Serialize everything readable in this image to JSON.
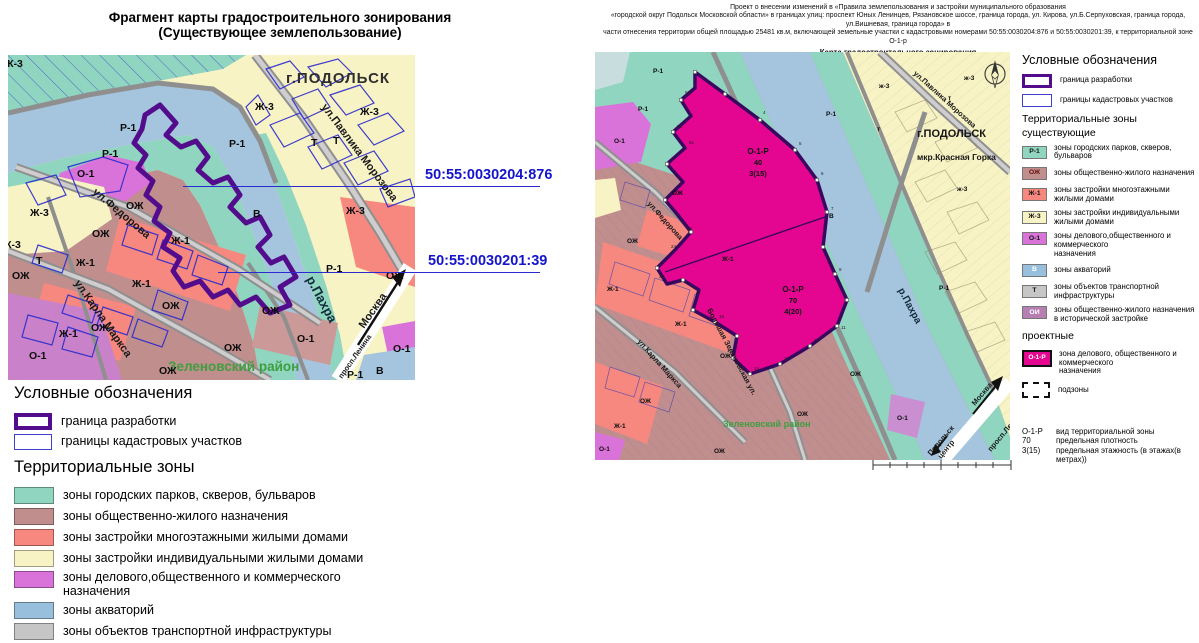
{
  "colors": {
    "boundary_purple": "#530d8c",
    "cadastral_blue": "#2a2ace",
    "magenta_project_zone": "#e40591",
    "teal_parks": "#8fd5bf",
    "rose_ozh": "#c18e8e",
    "salmon_zh1": "#f6887f",
    "yellow_zh3": "#f8f3c4",
    "orchid_o1": "#d973d9",
    "water": "#a5c4de",
    "gray_transport": "#c6c6c6",
    "mauve_oi": "#b77fb1",
    "green_district_text": "#3f9e3f",
    "blue_label_text": "#1414cc"
  },
  "left": {
    "title1": "Фрагмент карты градостроительного зонирования",
    "title2": "(Существующее землепользование)",
    "cad1": "50:55:0030204:876",
    "cad2": "50:55:0030201:39",
    "city": "г.ПОДОЛЬСК",
    "district": "Зеленовский район",
    "river": "р.Пахра",
    "moscow": "Москва",
    "st_lenina": "просп.Ленина",
    "st_pavlika": "ул.Павлика Морозова",
    "st_fedorova": "ул.Федорова",
    "st_karla": "ул.Карла Маркса",
    "codes": {
      "r1": "Р-1",
      "o1": "О-1",
      "zh1": "Ж-1",
      "zh3": "Ж-3",
      "ozh": "ОЖ",
      "t": "Т",
      "v": "В"
    },
    "legend": {
      "title": "Условные обозначения",
      "boundary": "граница разработки",
      "cadastral": "границы кадастровых участков",
      "zones_title": "Территориальные зоны",
      "items": [
        {
          "label": "зоны городских парков, скверов, бульваров",
          "label2": ""
        },
        {
          "label": "зоны общественно-жилого назначения",
          "label2": ""
        },
        {
          "label": "зоны застройки многоэтажными жилыми домами",
          "label2": ""
        },
        {
          "label": "зоны застройки индивидуальными жилыми домами",
          "label2": ""
        },
        {
          "label": "зоны делового,общественного и коммерческого",
          "label2": "назначения"
        },
        {
          "label": "зоны акваторий",
          "label2": ""
        },
        {
          "label": "зоны объектов транспортной инфраструктуры",
          "label2": ""
        },
        {
          "label": "зоны общественно-жилого назначения",
          "label2": "в исторической застройке"
        }
      ]
    }
  },
  "right": {
    "header1": "Проект о внесении изменений в «Правила землепользования и застройки муниципального образования",
    "header2": "«городской округ Подольск Московской области» в границах улиц: проспект Юных Ленинцев, Рязановское шоссе, граница города, ул. Кирова, ул.Б.Серпуховская, граница города, ул.Вишневая, граница города» в",
    "header3": "части отнесения территории общей площадью 25481 кв.м, включающей земельные участки с кадастровыми номерами 50:55:0030204:876 и 50:55:0030201:39, к территориальной зоне О-1-р",
    "header4": "Карта градостроительного зонирования",
    "city": "г.ПОДОЛЬСК",
    "mkr": "мкр.Красная Горка",
    "district": "Зеленовский район",
    "river": "р.Пахра",
    "moscow": "Москва",
    "center1": "Подольск",
    "center2": "центр",
    "st_lenina": "просп.Ленина",
    "st_pavlika": "ул.Павлика Морозова",
    "st_fedorova": "ул.Федорова",
    "st_karla": "ул.Карла Маркса",
    "st_zelenov": "Большая Зеленовская ул.",
    "codes": {
      "r1": "Р-1",
      "o1": "О-1",
      "zh1": "Ж-1",
      "zh3": "ж-3",
      "ozh": "ОЖ",
      "t": "т",
      "v": "В"
    },
    "zone1": {
      "code": "О-1-Р",
      "density": "40",
      "floors": "3(15)"
    },
    "zone2": {
      "code": "О-1-Р",
      "density": "70",
      "floors": "4(20)"
    },
    "vertices": [
      "53",
      "54",
      "61",
      "4",
      "5",
      "6",
      "7",
      "9",
      "11",
      "12",
      "13",
      "14",
      "15",
      "16",
      "23",
      "24",
      "25"
    ],
    "legend": {
      "title": "Условные обозначения",
      "boundary": "граница разработки",
      "cadastral": "границы кадастровых участков",
      "zones_title": "Территориальные зоны",
      "existing": "существующие",
      "items": [
        {
          "code": "Р-1",
          "text": "зоны городских парков, скверов, бульваров",
          "text2": ""
        },
        {
          "code": "ОЖ",
          "text": "зоны общественно-жилого назначения",
          "text2": ""
        },
        {
          "code": "Ж-1",
          "text": "зоны застройки многоэтажными жилыми домами",
          "text2": ""
        },
        {
          "code": "Ж-3",
          "text": "зоны застройки индивидуальными жилыми домами",
          "text2": ""
        },
        {
          "code": "О-1",
          "text": "зоны делового,общественного и коммерческого",
          "text2": "назначения"
        },
        {
          "code": "В",
          "text": "зоны акваторий",
          "text2": ""
        },
        {
          "code": "Т",
          "text": "зоны объектов транспортной инфраструктуры",
          "text2": ""
        },
        {
          "code": "ОИ",
          "text": "зоны общественно-жилого назначения",
          "text2": "в исторической застройке"
        }
      ],
      "projected": "проектные",
      "proj_code": "О-1-Р",
      "proj_text": "зона делового, общественного и коммерческого",
      "proj_text2": "назначения",
      "subzones": "подзоны",
      "key": [
        {
          "k": "О-1-Р",
          "v": "вид территориальной зоны"
        },
        {
          "k": "70",
          "v": "предельная плотность"
        },
        {
          "k": "3(15)",
          "v": "предельная этажность (в этажах(в метрах))"
        }
      ]
    }
  }
}
